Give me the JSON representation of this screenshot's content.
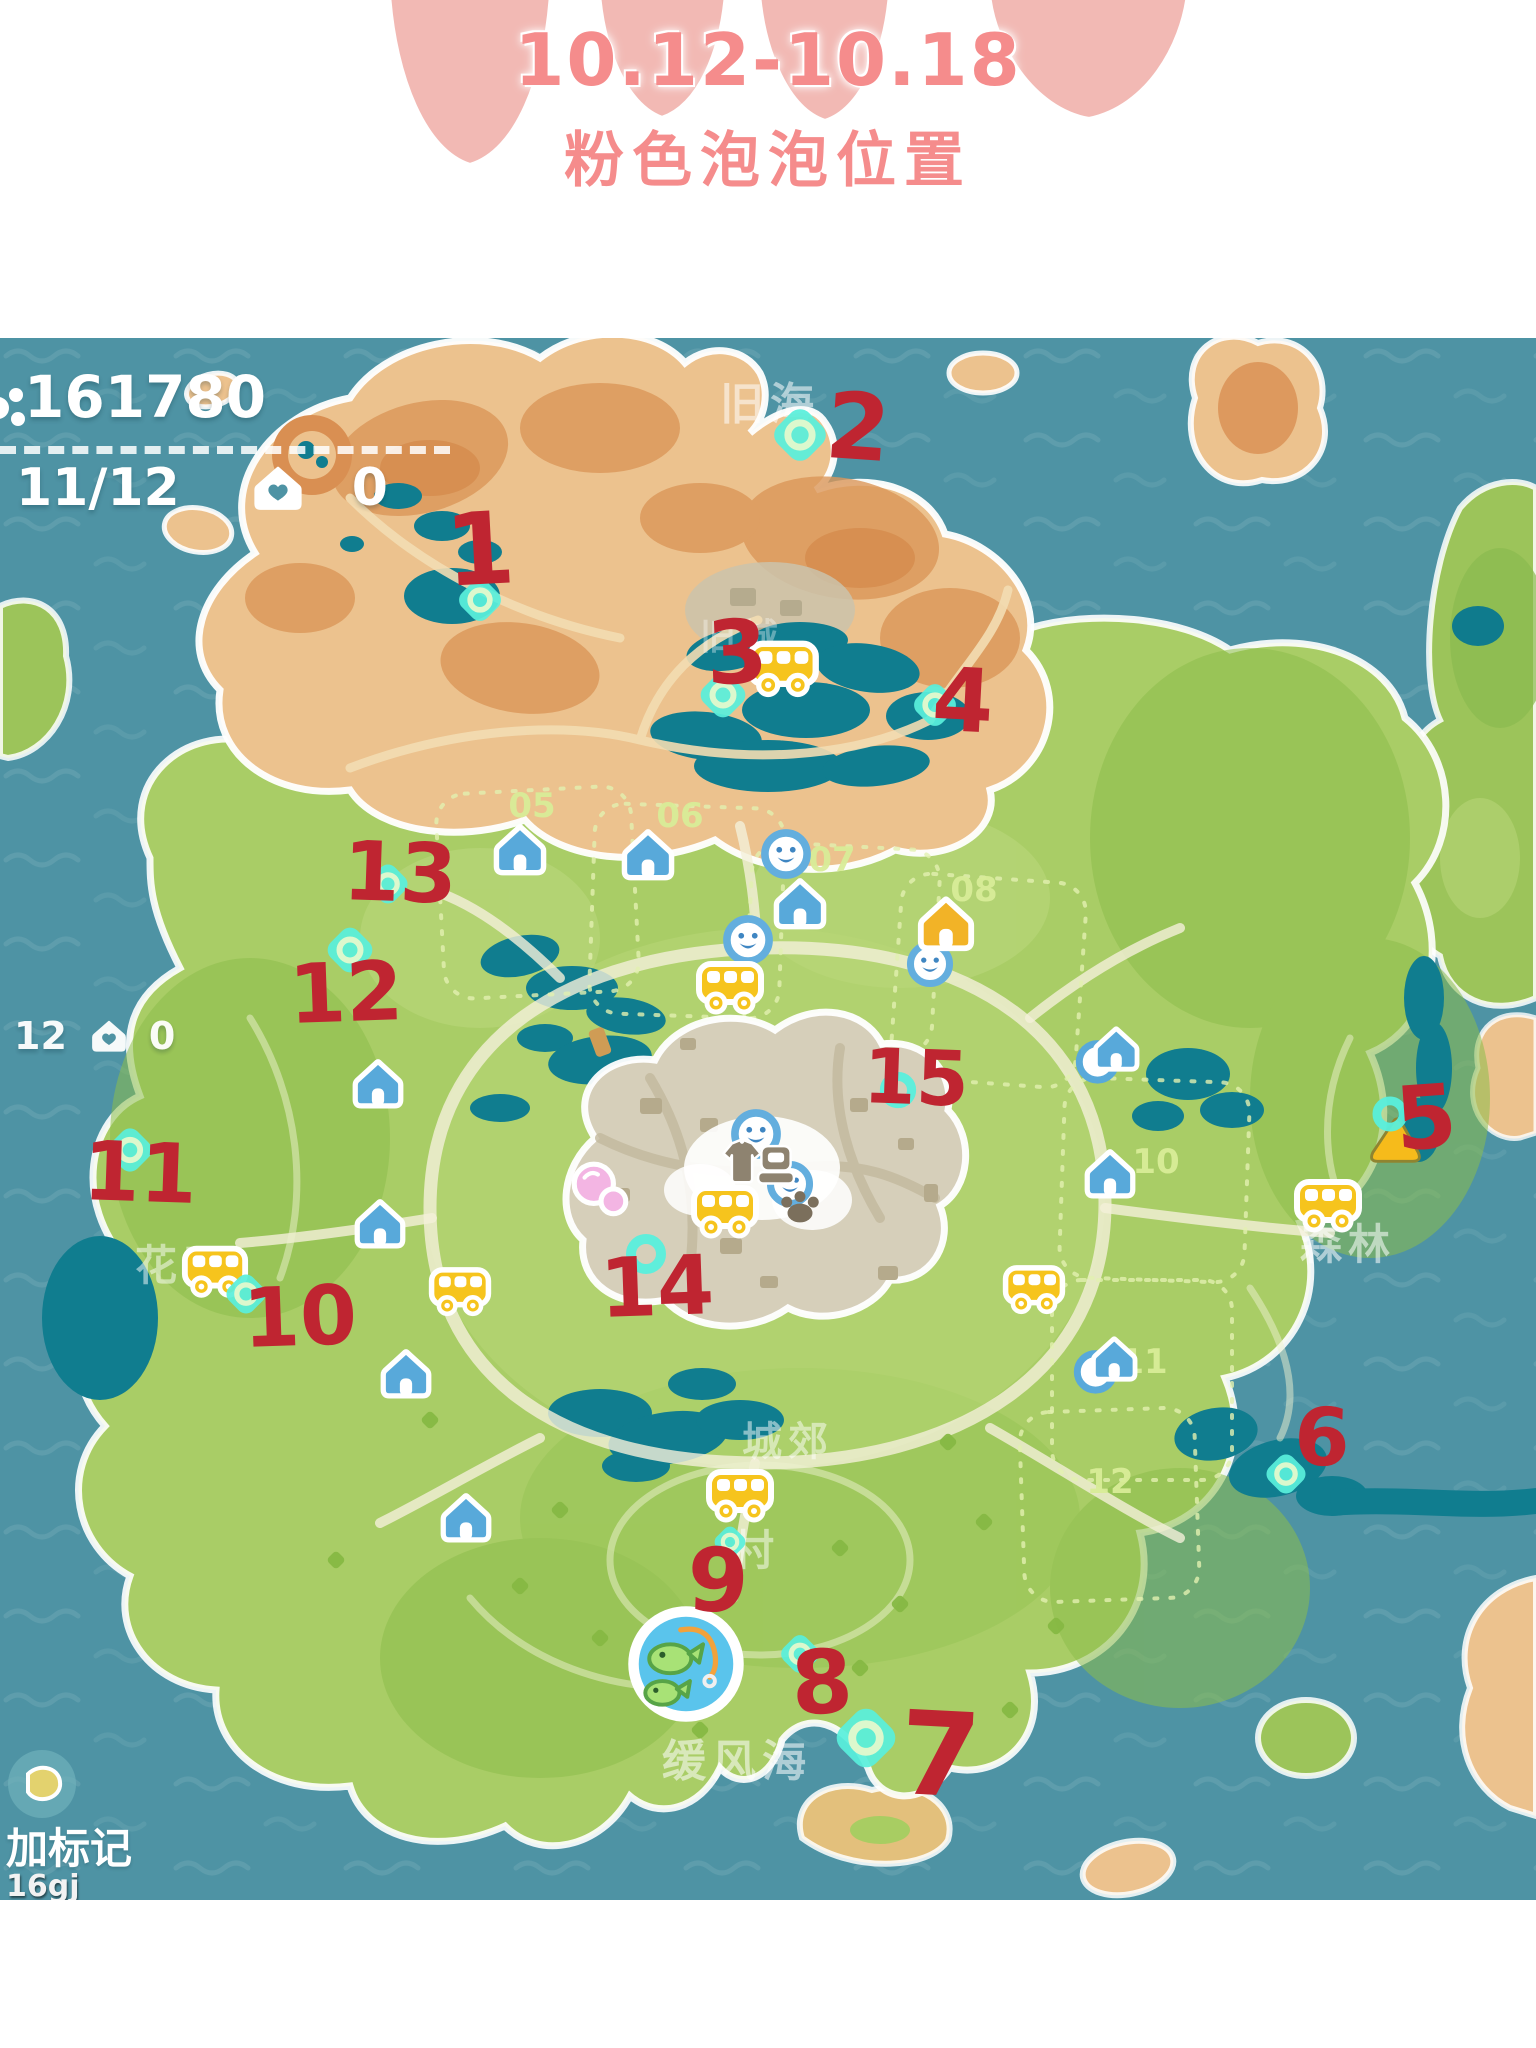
{
  "header": {
    "date_range": "10.12-10.18",
    "title": "粉色泡泡位置"
  },
  "hud": {
    "coins": "161780",
    "progress": "11/12",
    "homes": "0"
  },
  "hud_partial": {
    "progress": "12",
    "homes": "0"
  },
  "footer": {
    "add_marker_label": "加标记",
    "watermark": "16gj"
  },
  "colors": {
    "accent_pink": "#f58c8c",
    "marker_red": "#bf2531",
    "bubble_teal": "#59efdc",
    "water": "#4e93a4"
  },
  "map": {
    "region_labels": [
      {
        "text": "旧海",
        "x": 770,
        "y": 67,
        "size": 44,
        "op": 0.55
      },
      {
        "text": "旧城",
        "x": 742,
        "y": 300,
        "size": 36,
        "op": 0.35
      },
      {
        "text": "花田",
        "x": 183,
        "y": 928,
        "size": 42,
        "op": 0.5
      },
      {
        "text": "森林",
        "x": 1348,
        "y": 907,
        "size": 42,
        "op": 0.55
      },
      {
        "text": "城郊",
        "x": 788,
        "y": 1104,
        "size": 40,
        "op": 0.5
      },
      {
        "text": "村",
        "x": 756,
        "y": 1213,
        "size": 42,
        "op": 0.5
      },
      {
        "text": "缓风海",
        "x": 737,
        "y": 1424,
        "size": 44,
        "op": 0.55
      }
    ],
    "plot_labels": [
      {
        "text": "05",
        "x": 532,
        "y": 468
      },
      {
        "text": "06",
        "x": 680,
        "y": 478
      },
      {
        "text": "07",
        "x": 832,
        "y": 522
      },
      {
        "text": "08",
        "x": 974,
        "y": 552
      },
      {
        "text": "10",
        "x": 1156,
        "y": 824
      },
      {
        "text": "11",
        "x": 1144,
        "y": 1024
      },
      {
        "text": "12",
        "x": 1110,
        "y": 1144
      }
    ],
    "numbers": [
      {
        "n": "1",
        "x": 480,
        "y": 212,
        "s": 100,
        "r": -3
      },
      {
        "n": "2",
        "x": 858,
        "y": 90,
        "s": 92,
        "r": 4
      },
      {
        "n": "3",
        "x": 737,
        "y": 315,
        "s": 88,
        "r": -2
      },
      {
        "n": "4",
        "x": 963,
        "y": 363,
        "s": 88,
        "r": 3
      },
      {
        "n": "5",
        "x": 1426,
        "y": 780,
        "s": 88,
        "r": -4
      },
      {
        "n": "6",
        "x": 1322,
        "y": 1100,
        "s": 80,
        "r": 2
      },
      {
        "n": "7",
        "x": 940,
        "y": 1418,
        "s": 116,
        "r": 3
      },
      {
        "n": "8",
        "x": 822,
        "y": 1345,
        "s": 88,
        "r": -3
      },
      {
        "n": "9",
        "x": 718,
        "y": 1243,
        "s": 88,
        "r": 2
      },
      {
        "n": "10",
        "x": 300,
        "y": 980,
        "s": 82,
        "r": -2
      },
      {
        "n": "11",
        "x": 140,
        "y": 836,
        "s": 82,
        "r": 2
      },
      {
        "n": "12",
        "x": 346,
        "y": 656,
        "s": 82,
        "r": -2
      },
      {
        "n": "13",
        "x": 400,
        "y": 536,
        "s": 82,
        "r": 2
      },
      {
        "n": "14",
        "x": 657,
        "y": 950,
        "s": 82,
        "r": -2
      },
      {
        "n": "15",
        "x": 916,
        "y": 740,
        "s": 76,
        "r": 2
      }
    ],
    "bubbles": [
      {
        "x": 480,
        "y": 262,
        "s": 60,
        "t": "diamond"
      },
      {
        "x": 800,
        "y": 97,
        "s": 74,
        "t": "diamond"
      },
      {
        "x": 723,
        "y": 357,
        "s": 64,
        "t": "diamond"
      },
      {
        "x": 935,
        "y": 367,
        "s": 60,
        "t": "diamond"
      },
      {
        "x": 1390,
        "y": 776,
        "s": 56,
        "t": "ring"
      },
      {
        "x": 1286,
        "y": 1136,
        "s": 56,
        "t": "diamond"
      },
      {
        "x": 866,
        "y": 1400,
        "s": 84,
        "t": "diamond"
      },
      {
        "x": 800,
        "y": 1316,
        "s": 54,
        "t": "diamond"
      },
      {
        "x": 730,
        "y": 1204,
        "s": 44,
        "t": "diamond"
      },
      {
        "x": 246,
        "y": 956,
        "s": 56,
        "t": "diamond"
      },
      {
        "x": 130,
        "y": 812,
        "s": 62,
        "t": "diamond"
      },
      {
        "x": 350,
        "y": 612,
        "s": 64,
        "t": "diamond"
      },
      {
        "x": 388,
        "y": 546,
        "s": 56,
        "t": "diamond"
      },
      {
        "x": 646,
        "y": 916,
        "s": 64,
        "t": "ring"
      },
      {
        "x": 898,
        "y": 752,
        "s": 58,
        "t": "ring"
      }
    ],
    "houses": [
      {
        "x": 520,
        "y": 512,
        "s": 58,
        "color": "blue"
      },
      {
        "x": 648,
        "y": 517,
        "s": 58,
        "color": "blue"
      },
      {
        "x": 800,
        "y": 566,
        "s": 58,
        "color": "blue"
      },
      {
        "x": 378,
        "y": 746,
        "s": 56,
        "color": "blue"
      },
      {
        "x": 380,
        "y": 886,
        "s": 56,
        "color": "blue"
      },
      {
        "x": 406,
        "y": 1036,
        "s": 56,
        "color": "blue"
      },
      {
        "x": 466,
        "y": 1180,
        "s": 56,
        "color": "blue"
      },
      {
        "x": 1108,
        "y": 716,
        "s": 56,
        "color": "blue",
        "wave": true
      },
      {
        "x": 1110,
        "y": 836,
        "s": 56,
        "color": "blue"
      },
      {
        "x": 1106,
        "y": 1026,
        "s": 56,
        "color": "blue",
        "wave": true
      },
      {
        "x": 946,
        "y": 586,
        "s": 62,
        "color": "yellow"
      }
    ],
    "faces": [
      {
        "x": 786,
        "y": 516,
        "s": 54
      },
      {
        "x": 748,
        "y": 602,
        "s": 54
      },
      {
        "x": 930,
        "y": 626,
        "s": 50
      },
      {
        "x": 756,
        "y": 796,
        "s": 54
      },
      {
        "x": 790,
        "y": 846,
        "s": 50
      }
    ],
    "buses": [
      {
        "x": 783,
        "y": 329,
        "s": 76
      },
      {
        "x": 730,
        "y": 648,
        "s": 72
      },
      {
        "x": 215,
        "y": 932,
        "s": 70
      },
      {
        "x": 460,
        "y": 952,
        "s": 66
      },
      {
        "x": 725,
        "y": 872,
        "s": 72
      },
      {
        "x": 1034,
        "y": 950,
        "s": 66
      },
      {
        "x": 1328,
        "y": 866,
        "s": 72
      },
      {
        "x": 740,
        "y": 1156,
        "s": 72
      }
    ],
    "specials": [
      {
        "t": "tent",
        "x": 1396,
        "y": 802,
        "s": 62
      },
      {
        "t": "pond",
        "x": 686,
        "y": 1326,
        "s": 126
      },
      {
        "t": "pink",
        "x": 600,
        "y": 852,
        "s": 66
      },
      {
        "t": "shirt",
        "x": 742,
        "y": 824,
        "s": 54
      },
      {
        "t": "robot",
        "x": 776,
        "y": 826,
        "s": 52
      },
      {
        "t": "paw",
        "x": 800,
        "y": 868,
        "s": 50
      }
    ]
  }
}
